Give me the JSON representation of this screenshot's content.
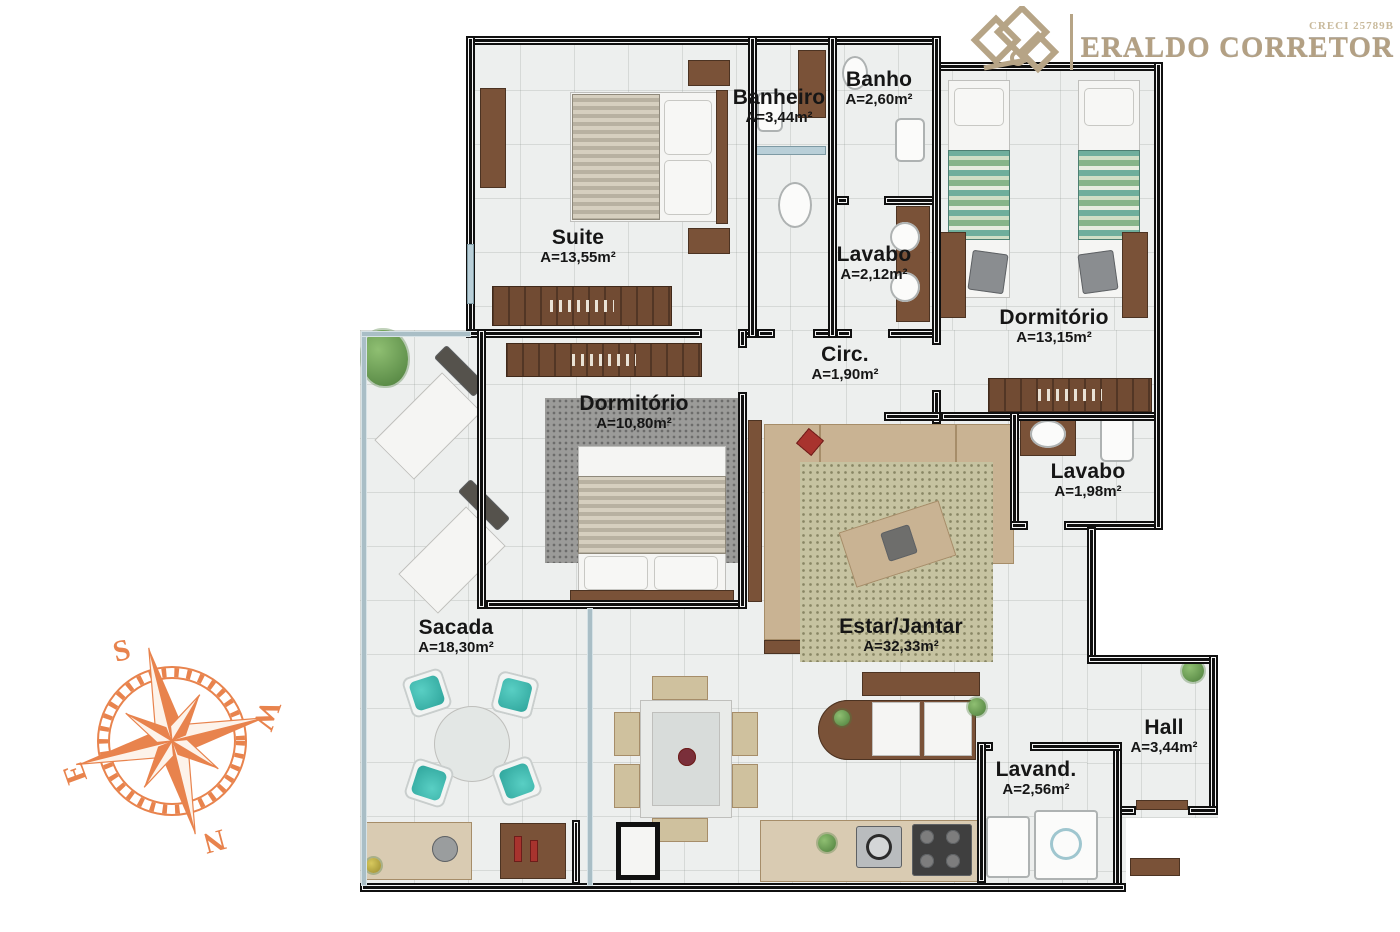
{
  "branding": {
    "company": "ERALDO CORRETOR",
    "creci": "CRECI 25789B",
    "logo_color": "#b3a083"
  },
  "compass": {
    "color": "#e8834d",
    "letters": {
      "top": "S",
      "right": "W",
      "left": "E",
      "bottom": "N"
    }
  },
  "floor_plan": {
    "rooms": {
      "suite": {
        "name": "Suite",
        "area": "A=13,55m²"
      },
      "banheiro": {
        "name": "Banheiro",
        "area": "A=3,44m²"
      },
      "banho": {
        "name": "Banho",
        "area": "A=2,60m²"
      },
      "lavabo_sup": {
        "name": "Lavabo",
        "area": "A=2,12m²"
      },
      "dormitorio_1": {
        "name": "Dormitório",
        "area": "A=13,15m²"
      },
      "circulacao": {
        "name": "Circ.",
        "area": "A=1,90m²"
      },
      "dormitorio_2": {
        "name": "Dormitório",
        "area": "A=10,80m²"
      },
      "lavabo_2": {
        "name": "Lavabo",
        "area": "A=1,98m²"
      },
      "sacada": {
        "name": "Sacada",
        "area": "A=18,30m²"
      },
      "estar_jantar": {
        "name": "Estar/Jantar",
        "area": "A=32,33m²"
      },
      "hall": {
        "name": "Hall",
        "area": "A=3,44m²"
      },
      "lavanderia": {
        "name": "Lavand.",
        "area": "A=2,56m²"
      }
    }
  }
}
